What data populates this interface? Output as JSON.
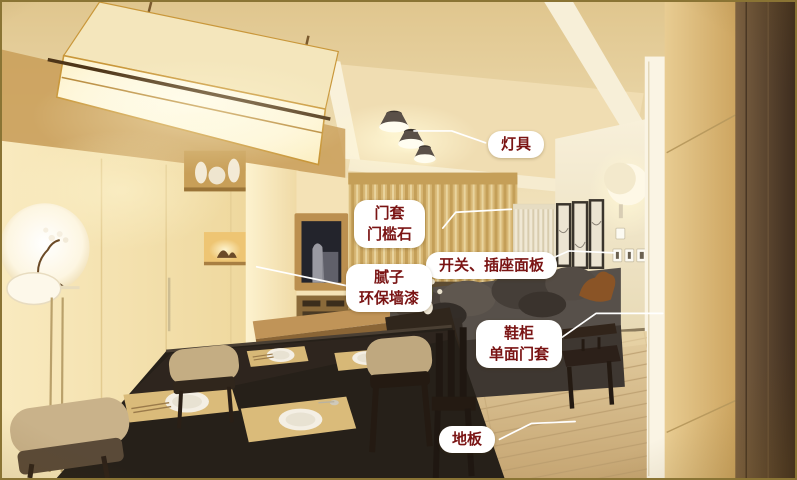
{
  "palette": {
    "frame_border": "#8a7434",
    "label_text": "#7a1414",
    "label_background": "#ffffff",
    "leader_line": "#ffffff"
  },
  "annotations": {
    "labels": [
      {
        "id": "lamps",
        "line1": "灯具"
      },
      {
        "id": "door-casing",
        "line1": "门套",
        "line2": "门槛石"
      },
      {
        "id": "switch-socket-panels",
        "line1": "开关、插座面板"
      },
      {
        "id": "putty-wall-paint",
        "line1": "腻子",
        "line2": "环保墙漆"
      },
      {
        "id": "shoe-cabinet",
        "line1": "鞋柜",
        "line2": "单面门套"
      },
      {
        "id": "floor",
        "line1": "地板"
      }
    ]
  }
}
